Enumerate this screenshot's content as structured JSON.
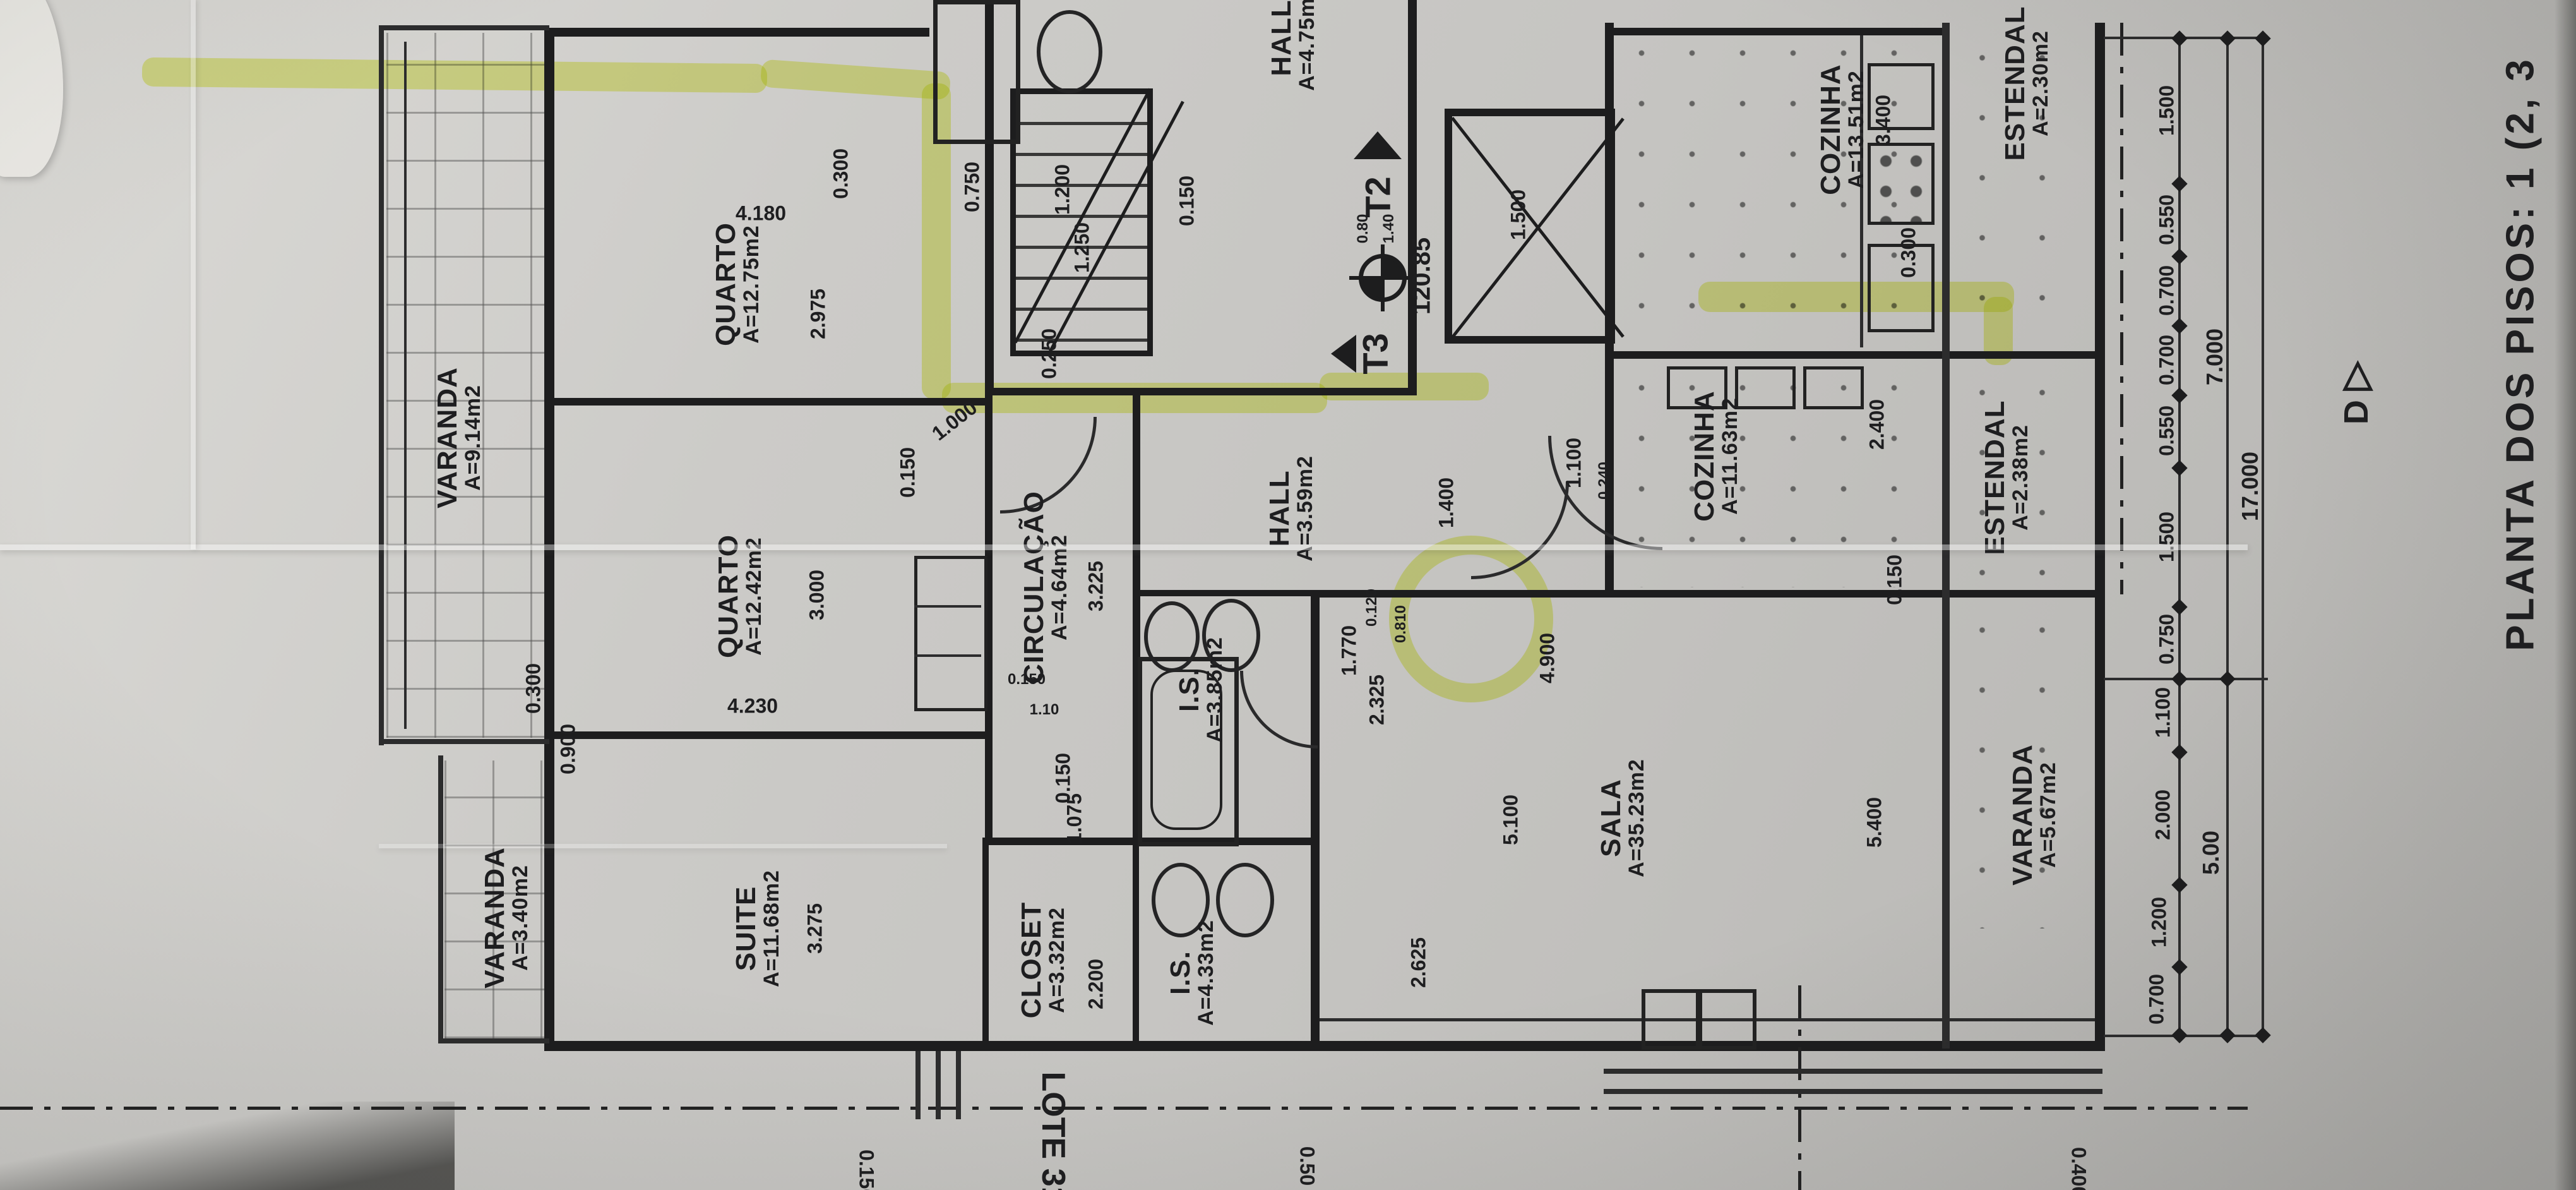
{
  "meta": {
    "title": "PLANTA DOS PISOS: 1 (2, 3",
    "lot_label": "LOTE 31",
    "section_marker": "D",
    "section_marker_glyph": "▷",
    "level_value": "120.85",
    "unit_t2": "T2",
    "unit_t3": "T3",
    "colors": {
      "paper": "#c7c6c2",
      "ink": "#1d1d1e",
      "highlighter": "#e0ee3a"
    }
  },
  "rooms": [
    {
      "name": "VARANDA",
      "area": "A=9.14m2"
    },
    {
      "name": "QUARTO",
      "area": "A=12.75m2"
    },
    {
      "name": "QUARTO",
      "area": "A=12.42m2"
    },
    {
      "name": "CIRCULAÇÃO",
      "area": "A=4.64m2"
    },
    {
      "name": "HALL",
      "area": "A=3.59m2"
    },
    {
      "name": "I.S.",
      "area": "A=3.85m2"
    },
    {
      "name": "SUITE",
      "area": "A=11.68m2"
    },
    {
      "name": "CLOSET",
      "area": "A=3.32m2"
    },
    {
      "name": "I.S.",
      "area": "A=4.33m2"
    },
    {
      "name": "VARANDA",
      "area": "A=3.40m2"
    },
    {
      "name": "SALA",
      "area": "A=35.23m2"
    },
    {
      "name": "COZINHA",
      "area": "A=13.51m2"
    },
    {
      "name": "ESTENDAL",
      "area": "A=2.30m2"
    },
    {
      "name": "COZINHA",
      "area": "A=11.63m2"
    },
    {
      "name": "ESTENDAL",
      "area": "A=2.38m2"
    },
    {
      "name": "VARANDA",
      "area": "A=5.67m2"
    },
    {
      "name": "HALL",
      "area": "A=4.75m2"
    }
  ],
  "dims": [
    "0.300",
    "4.180",
    "2.975",
    "0.750",
    "1.200",
    "1.250",
    "0.150",
    "0.250",
    "1.000",
    "0.150",
    "3.000",
    "4.230",
    "0.300",
    "0.900",
    "3.225",
    "0.150",
    "1.10",
    "3.275",
    "1.075",
    "0.150",
    "2.200",
    "1.400",
    "2.325",
    "1.770",
    "0.120",
    "0.810",
    "2.625",
    "5.100",
    "4.900",
    "5.400",
    "1.100",
    "0.240",
    "2.400",
    "0.150",
    "3.400",
    "0.300",
    "1.500",
    "0.80",
    "1.40",
    "1.500",
    "0.550",
    "0.700",
    "0.700",
    "0.550",
    "1.500",
    "0.750",
    "1.100",
    "2.000",
    "1.200",
    "0.700",
    "7.000",
    "17.000",
    "5.00",
    "0.50",
    "0.150",
    "0.400"
  ]
}
